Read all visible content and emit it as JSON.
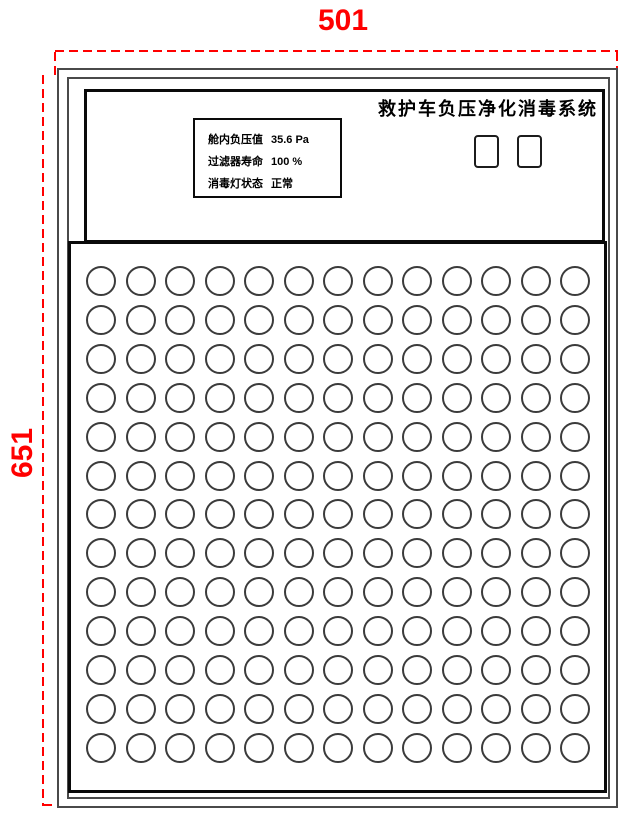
{
  "drawing": {
    "dimension_width": "501",
    "dimension_height": "651",
    "dimension_color": "#ff0000",
    "outline_color": "#4a4a4a",
    "section_border_color": "#0a0a0a"
  },
  "panel": {
    "title": "救护车负压净化消毒系统",
    "status_display": {
      "lines": [
        {
          "label": "舱内负压值",
          "value": "35.6 Pa"
        },
        {
          "label": "过滤器寿命",
          "value": "100 %"
        },
        {
          "label": "消毒灯状态",
          "value": "正常"
        }
      ]
    },
    "buttons": {
      "count": 2
    },
    "hole_grid": {
      "rows": 13,
      "cols": 13,
      "total_holes": 169
    }
  }
}
